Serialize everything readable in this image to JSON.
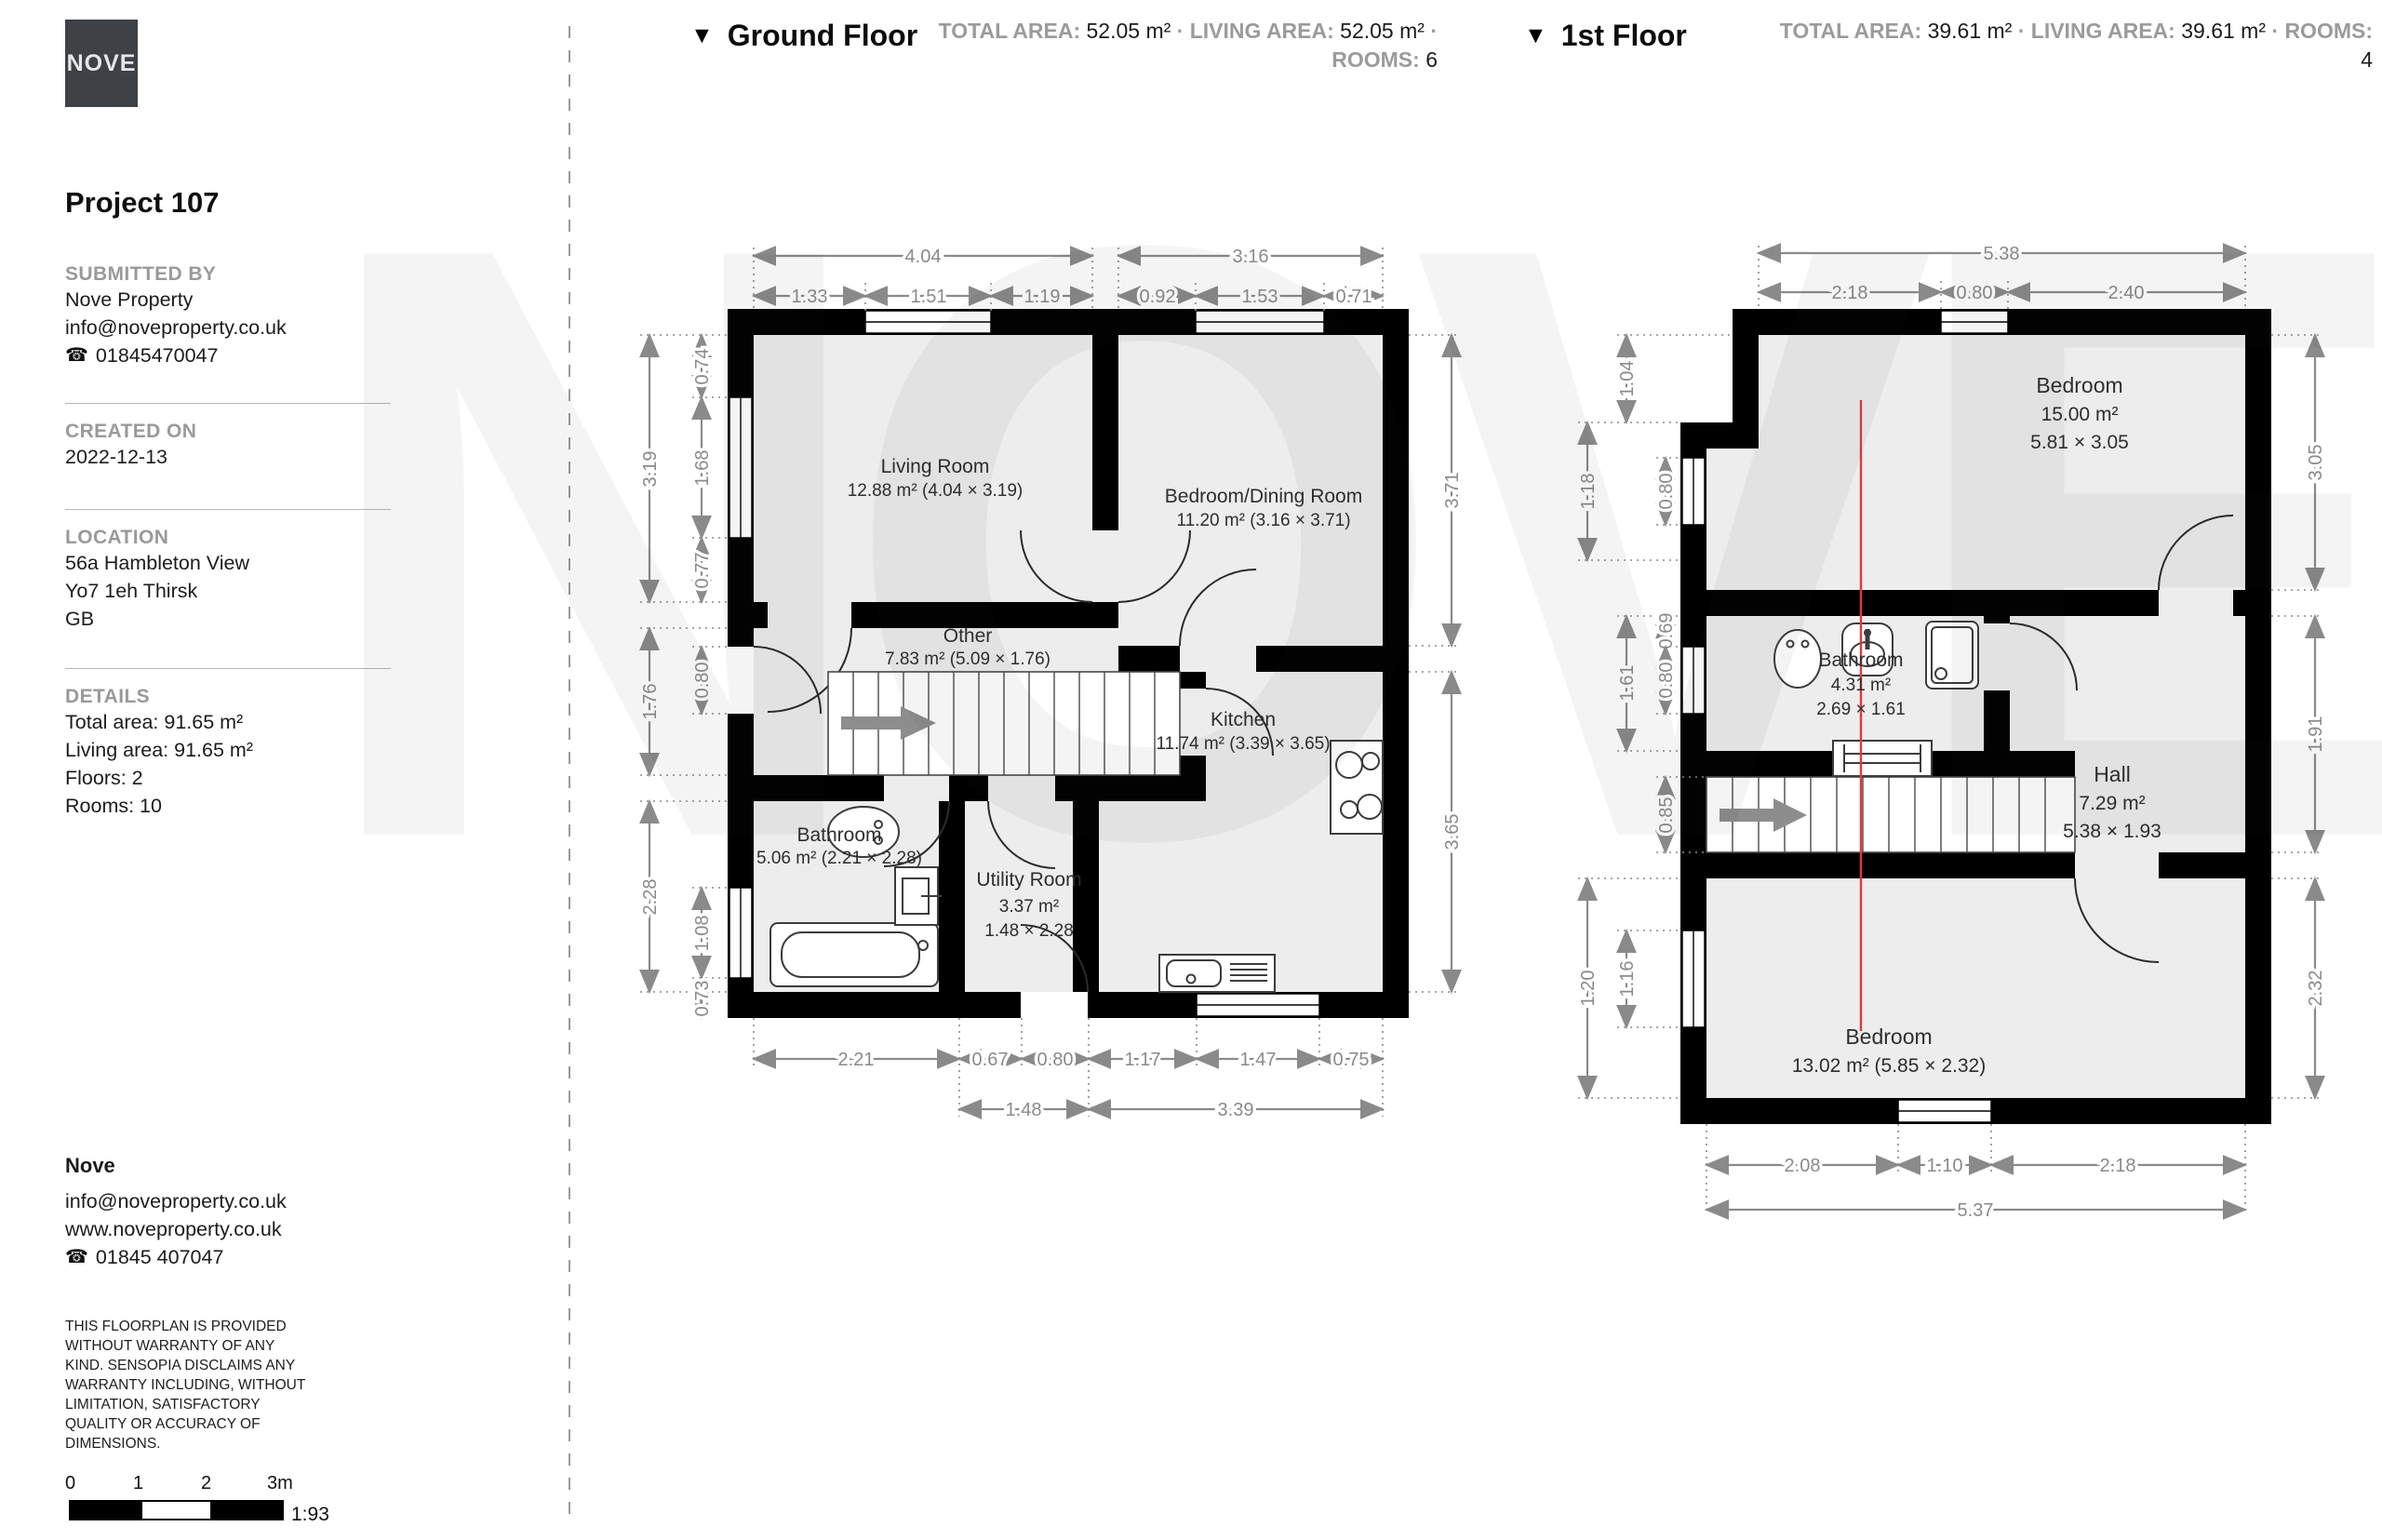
{
  "watermark": "NOVE",
  "logo": "NOVE",
  "icons": {
    "floor_marker": "▼",
    "phone": "☎"
  },
  "sidebar": {
    "project_title": "Project 107",
    "submitted_by": {
      "label": "SUBMITTED BY",
      "name": "Nove Property",
      "email": "info@noveproperty.co.uk",
      "phone": "01845470047"
    },
    "created_on": {
      "label": "CREATED ON",
      "date": "2022-12-13"
    },
    "location": {
      "label": "LOCATION",
      "address1": "56a Hambleton View",
      "address2": "Yo7 1eh Thirsk",
      "address3": "GB"
    },
    "details": {
      "label": "DETAILS",
      "lines": [
        "Total area: 91.65 m²",
        "Living area: 91.65 m²",
        "Floors: 2",
        "Rooms: 10"
      ]
    },
    "footer": {
      "name": "Nove",
      "email": "info@noveproperty.co.uk",
      "website": "www.noveproperty.co.uk",
      "phone": "01845 407047"
    },
    "disclaimer": "THIS FLOORPLAN IS PROVIDED WITHOUT WARRANTY OF ANY KIND. SENSOPIA DISCLAIMS ANY WARRANTY INCLUDING, WITHOUT LIMITATION, SATISFACTORY QUALITY OR ACCURACY OF DIMENSIONS.",
    "scale": {
      "ticks": [
        "0",
        "1",
        "2",
        "3m"
      ],
      "ratio": "1:93"
    }
  },
  "ground_floor": {
    "title": "Ground Floor",
    "stats": {
      "total_label": "TOTAL AREA:",
      "total": "52.05 m²",
      "living_label": "LIVING AREA:",
      "living": "52.05 m²",
      "rooms_label": "ROOMS:",
      "rooms": "6",
      "sep": "·"
    },
    "rooms": {
      "living": {
        "name": "Living Room",
        "area": "12.88 m² (4.04 × 3.19)"
      },
      "bedroom_dining": {
        "name": "Bedroom/Dining Room",
        "area": "11.20 m² (3.16 × 3.71)"
      },
      "other": {
        "name": "Other",
        "area": "7.83 m² (5.09 × 1.76)"
      },
      "bathroom": {
        "name": "Bathroom",
        "area": "5.06 m² (2.21 × 2.28)"
      },
      "utility": {
        "name": "Utility Room",
        "area": "3.37 m²",
        "dims": "1.48 × 2.28"
      },
      "kitchen": {
        "name": "Kitchen",
        "area": "11.74 m² (3.39 × 3.65)"
      }
    },
    "dims": {
      "top_overall": [
        "4.04",
        "3.16"
      ],
      "top_segs": [
        "1.33",
        "1.51",
        "1.19",
        "0.92",
        "1.53",
        "0.71"
      ],
      "left_outer": [
        "3.19",
        "1.76",
        "2.28"
      ],
      "left_inner": [
        "0.74",
        "1.68",
        "0.77",
        "0.80",
        "1.08",
        "0.73"
      ],
      "right": [
        "3.71",
        "3.65"
      ],
      "bottom_segs": [
        "2.21",
        "0.67",
        "0.80",
        "1.17",
        "1.47",
        "0.75"
      ],
      "bottom_overall": [
        "1.48",
        "3.39"
      ]
    }
  },
  "first_floor": {
    "title": "1st Floor",
    "stats": {
      "total_label": "TOTAL AREA:",
      "total": "39.61 m²",
      "living_label": "LIVING AREA:",
      "living": "39.61 m²",
      "rooms_label": "ROOMS:",
      "rooms": "4",
      "sep": "·"
    },
    "rooms": {
      "bedroom_top": {
        "name": "Bedroom",
        "area": "15.00 m²",
        "dims": "5.81 × 3.05"
      },
      "bathroom": {
        "name": "Bathroom",
        "area": "4.31 m²",
        "dims": "2.69 × 1.61"
      },
      "hall": {
        "name": "Hall",
        "area": "7.29 m²",
        "dims": "5.38 × 1.93"
      },
      "bedroom_bottom": {
        "name": "Bedroom",
        "area": "13.02 m² (5.85 × 2.32)"
      }
    },
    "dims": {
      "top_overall": [
        "5.38"
      ],
      "top_segs": [
        "2.18",
        "0.80",
        "2.40"
      ],
      "left_outer": [
        "1.18",
        "1.20"
      ],
      "left_mid": [
        "1.04",
        "1.61",
        "1.16"
      ],
      "left_inner": [
        "0.80",
        "0.69",
        "0.80",
        "0.85"
      ],
      "right": [
        "3.05",
        "1.91",
        "2.32"
      ],
      "bottom_segs": [
        "2.08",
        "1.10",
        "2.18"
      ],
      "bottom_overall": [
        "5.37"
      ]
    }
  }
}
